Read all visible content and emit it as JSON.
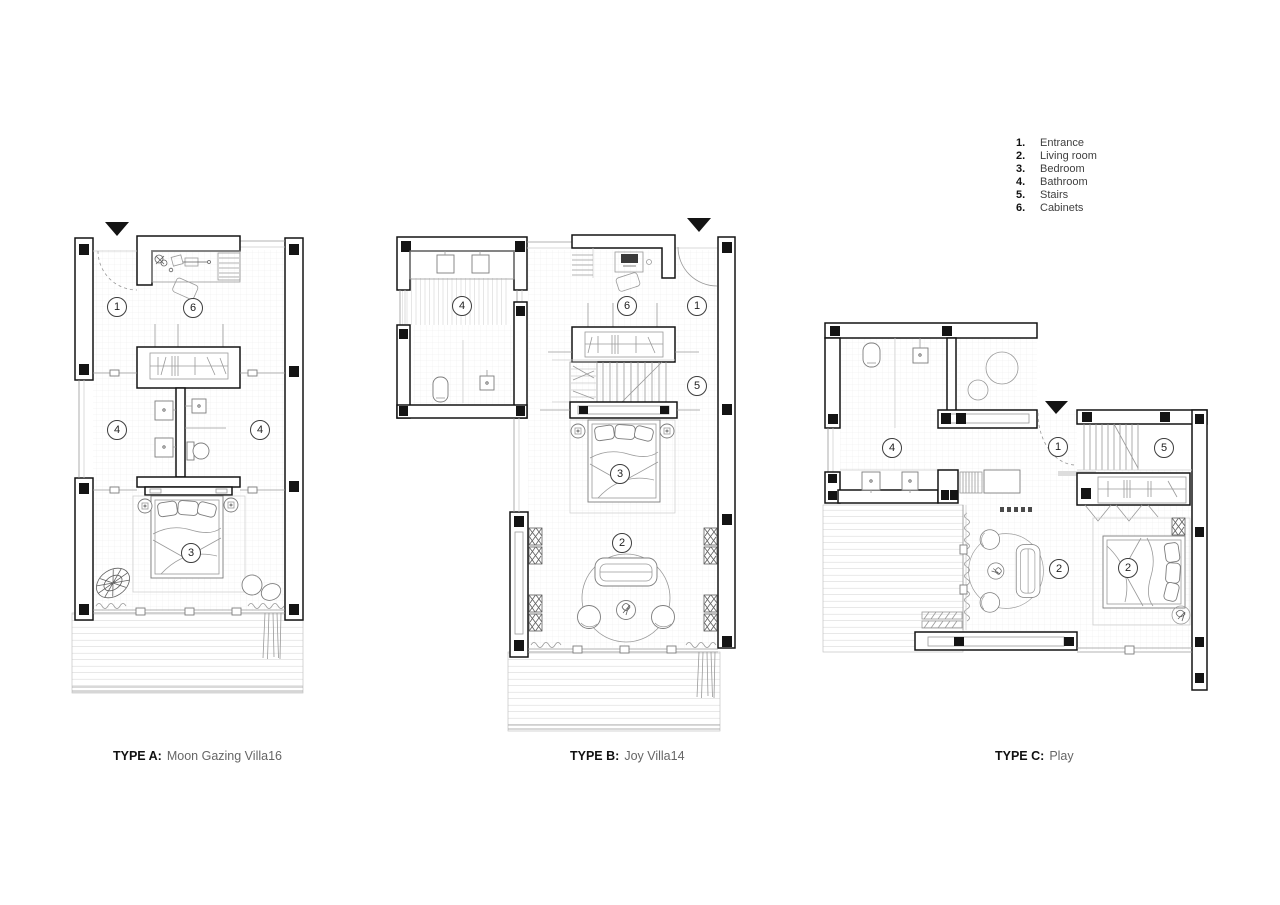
{
  "page": {
    "background": "#ffffff",
    "width": 1280,
    "height": 905
  },
  "legend": {
    "items": [
      {
        "number": "1.",
        "label": "Entrance"
      },
      {
        "number": "2.",
        "label": "Living room"
      },
      {
        "number": "3.",
        "label": "Bedroom"
      },
      {
        "number": "4.",
        "label": "Bathroom"
      },
      {
        "number": "5.",
        "label": "Stairs"
      },
      {
        "number": "6.",
        "label": "Cabinets"
      }
    ]
  },
  "plans": [
    {
      "id": "type-a",
      "caption_prefix": "TYPE A:",
      "caption_text": "Moon Gazing Villa16",
      "rooms": [
        {
          "number": "1",
          "name": "Entrance"
        },
        {
          "number": "6",
          "name": "Cabinets"
        },
        {
          "number": "4",
          "name": "Bathroom"
        },
        {
          "number": "4",
          "name": "Bathroom"
        },
        {
          "number": "3",
          "name": "Bedroom"
        }
      ]
    },
    {
      "id": "type-b",
      "caption_prefix": "TYPE B:",
      "caption_text": "Joy Villa14",
      "rooms": [
        {
          "number": "4",
          "name": "Bathroom"
        },
        {
          "number": "6",
          "name": "Cabinets"
        },
        {
          "number": "1",
          "name": "Entrance"
        },
        {
          "number": "5",
          "name": "Stairs"
        },
        {
          "number": "3",
          "name": "Bedroom"
        },
        {
          "number": "2",
          "name": "Living room"
        }
      ]
    },
    {
      "id": "type-c",
      "caption_prefix": "TYPE C:",
      "caption_text": "Play",
      "rooms": [
        {
          "number": "4",
          "name": "Bathroom"
        },
        {
          "number": "1",
          "name": "Entrance"
        },
        {
          "number": "5",
          "name": "Stairs"
        },
        {
          "number": "2",
          "name": "Living room"
        },
        {
          "number": "2",
          "name": "Living room"
        }
      ]
    }
  ],
  "colors": {
    "wall_line": "#141414",
    "furniture_line": "#7d7d7d",
    "caption_muted": "#666666",
    "text": "#1a1a1a"
  }
}
